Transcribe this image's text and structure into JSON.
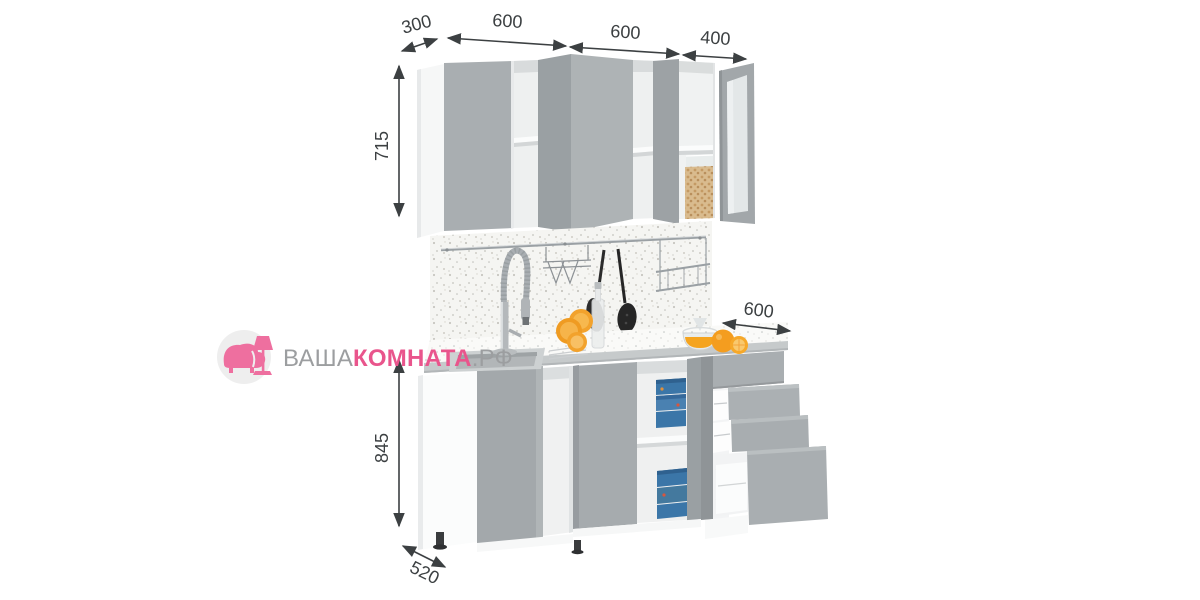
{
  "brand": {
    "prefix": "ВАША",
    "highlight": "КОМНАТА",
    "suffix": ".РФ",
    "accent_color": "#e9558c",
    "muted_color": "#9c9ea0",
    "icon": "armchair-floor-lamp-icon",
    "icon_color": "#ee6f9f"
  },
  "dimensions_mm": {
    "wall_cabinet_depth": "300",
    "wall_cabinet_left_width": "600",
    "wall_cabinet_center_width": "600",
    "wall_cabinet_right_width": "400",
    "wall_cabinet_height": "715",
    "base_cabinet_height": "845",
    "base_right_unit_width": "600",
    "base_cabinet_depth": "520"
  },
  "colors": {
    "dimension_line": "#3c4042",
    "cabinet_front_gray": "#a8adb0",
    "cabinet_carcass_white": "#f7f8f8",
    "countertop_edge": "#c6cacb",
    "backsplash_base": "#f5f5f2",
    "accent_orange": "#f2a12a",
    "container_blue": "#3b76a8"
  }
}
